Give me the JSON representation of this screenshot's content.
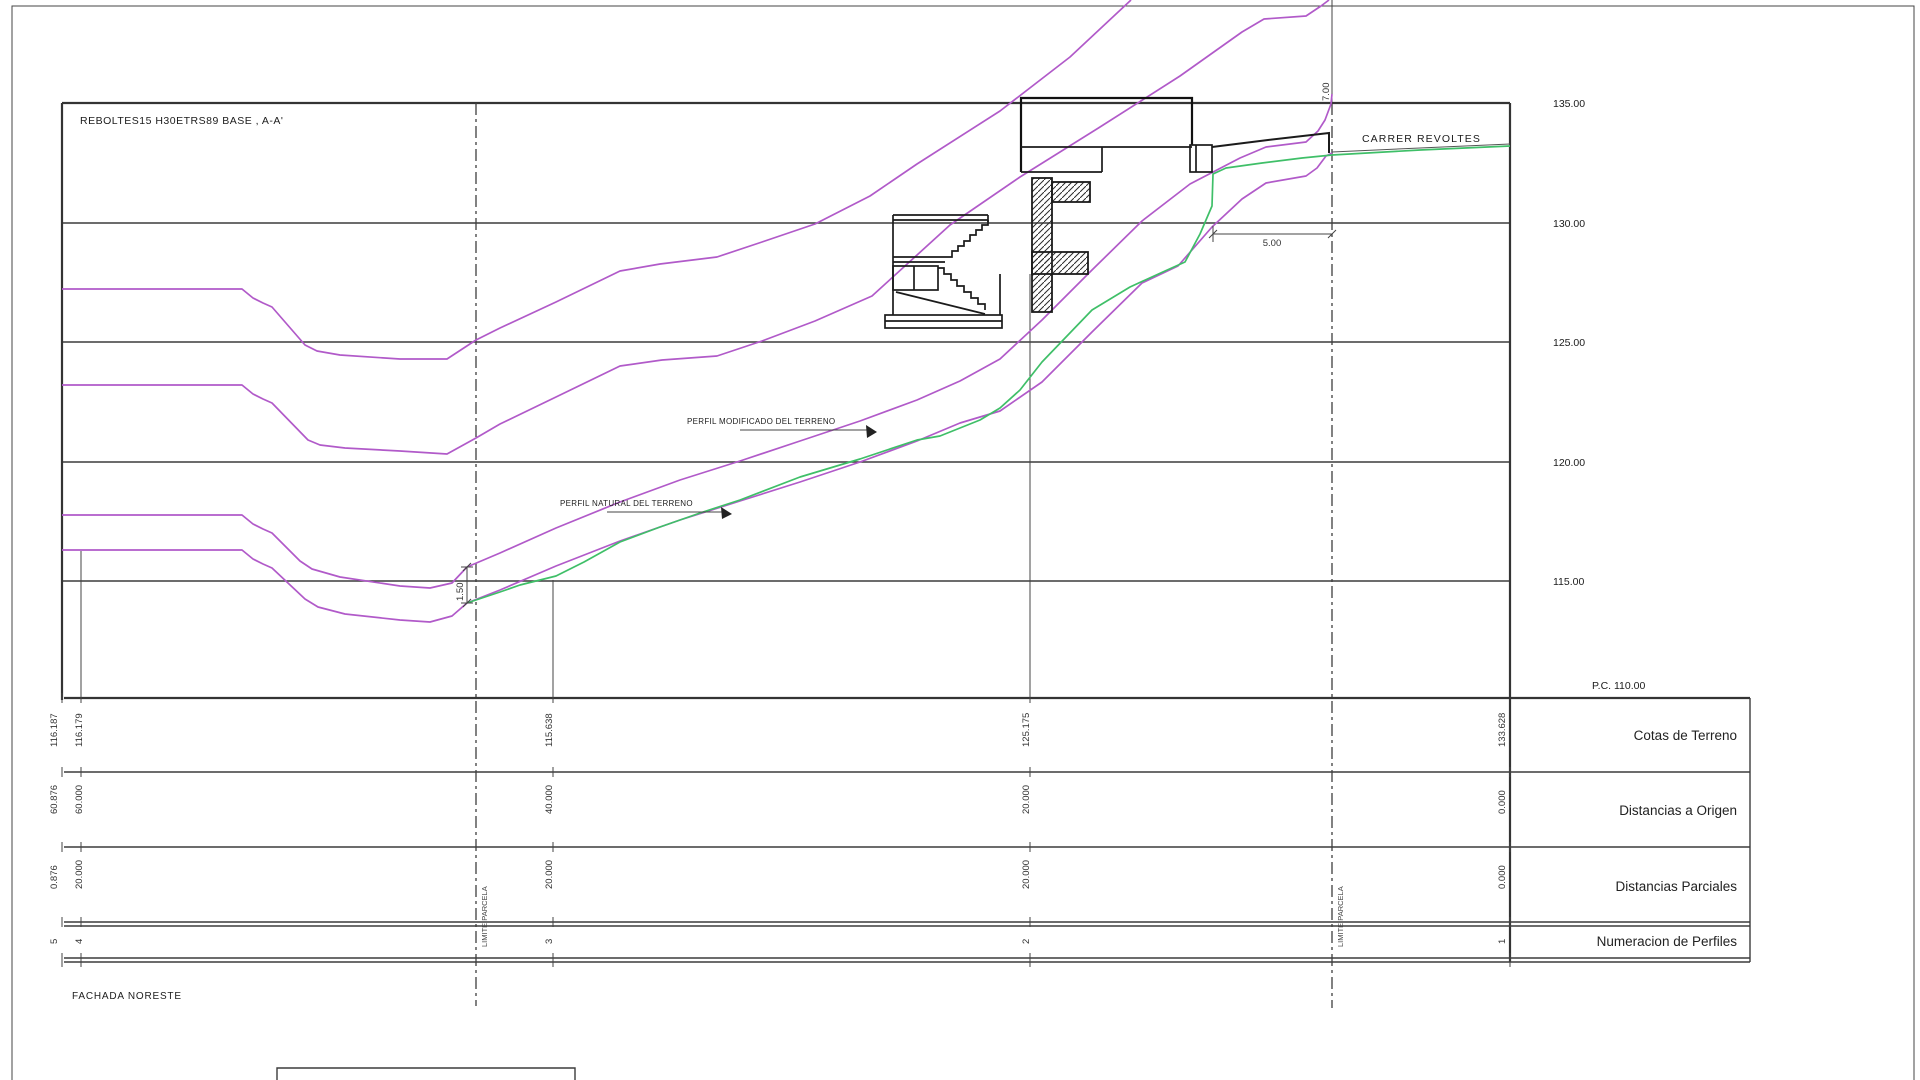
{
  "drawing": {
    "title": "REBOLTES15 H30ETRS89 BASE , A-A'",
    "street_label": "CARRER REVOLTES",
    "facade_label": "FACHADA NORESTE",
    "profile_modified_label": "PERFIL MODIFICADO DEL TERRENO",
    "profile_natural_label": "PERFIL NATURAL DEL TERRENO",
    "datum_label": "P.C. 110.00",
    "elevations": [
      "135.00",
      "130.00",
      "125.00",
      "120.00",
      "115.00"
    ],
    "parcel_limit_label": "LIMITE PARCELA",
    "dimensions": {
      "road_width": "5.00",
      "street_offset": "7.00",
      "terrain_gap": "1.50"
    },
    "colors": {
      "terrain_natural": "#b15ac9",
      "terrain_modified": "#3fbf68",
      "grid": "#3c3c3c"
    }
  },
  "table": {
    "row_labels": [
      "Cotas de Terreno",
      "Distancias a Origen",
      "Distancias Parciales",
      "Numeracion de Perfiles"
    ],
    "cotas": [
      "116.187",
      "116.179",
      "115.638",
      "125.175",
      "133.628"
    ],
    "origen": [
      "60.876",
      "60.000",
      "40.000",
      "20.000",
      "0.000"
    ],
    "parciales": [
      "0.876",
      "20.000",
      "20.000",
      "20.000",
      "0.000"
    ],
    "numeros": [
      "5",
      "4",
      "3",
      "2",
      "1"
    ]
  },
  "chart_data": {
    "type": "table",
    "title": "Perfil longitudinal A-A'",
    "columns": [
      "Numeracion de Perfiles",
      "Distancias a Origen",
      "Distancias Parciales",
      "Cotas de Terreno"
    ],
    "rows": [
      [
        "5",
        "60.876",
        "0.876",
        "116.187"
      ],
      [
        "4",
        "60.000",
        "20.000",
        "116.179"
      ],
      [
        "3",
        "40.000",
        "20.000",
        "115.638"
      ],
      [
        "2",
        "20.000",
        "20.000",
        "125.175"
      ],
      [
        "1",
        "0.000",
        "0.000",
        "133.628"
      ]
    ],
    "ylabels": [
      "135.00",
      "130.00",
      "125.00",
      "120.00",
      "115.00"
    ],
    "datum": "P.C. 110.00"
  }
}
